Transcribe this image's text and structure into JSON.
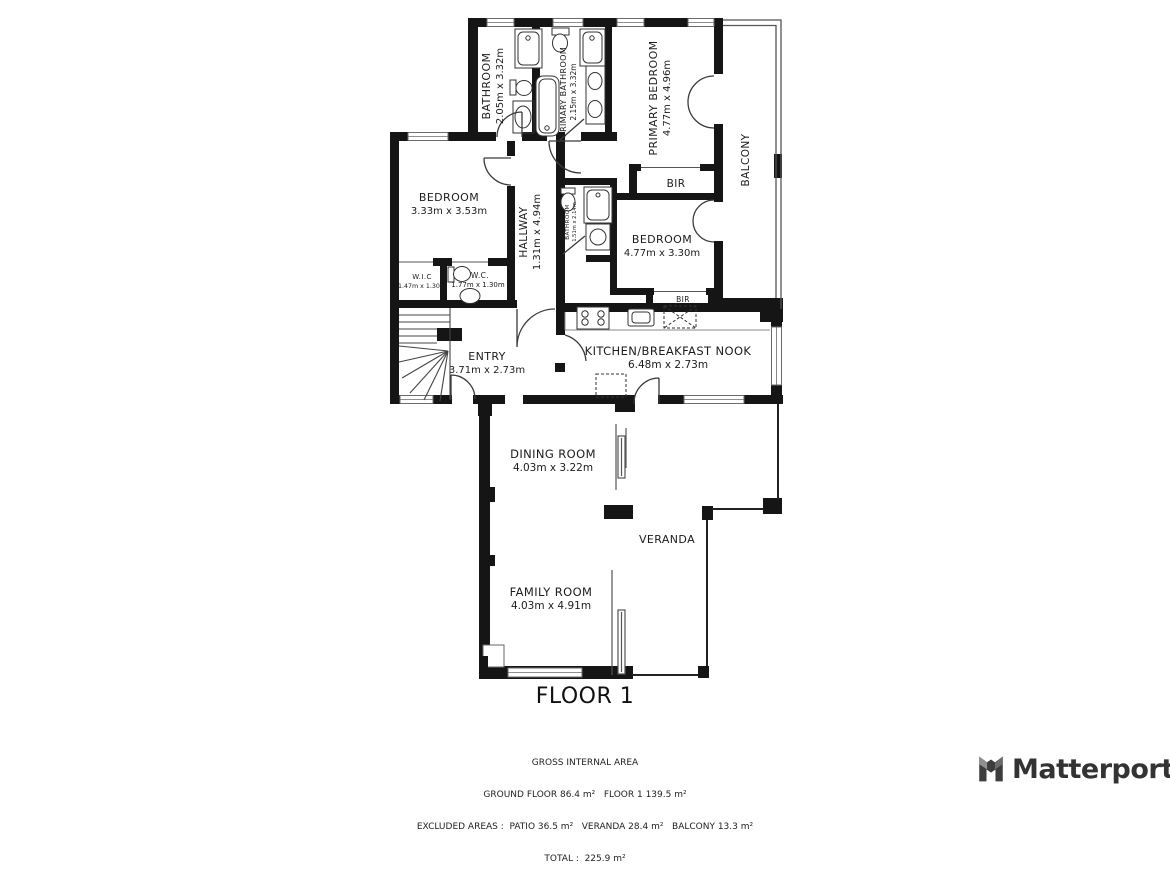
{
  "title": "FLOOR 1",
  "colors": {
    "wall": "#151515",
    "door_line": "#3a3a3a",
    "thin_line": "#666666",
    "brand_gray": "#3b3b3b"
  },
  "rooms": {
    "bathroom": {
      "name": "BATHROOM",
      "dims": "2.05m x 3.32m"
    },
    "primary_bathroom": {
      "name": "PRIMARY BATHROOM",
      "dims": "2.15m x 3.32m"
    },
    "primary_bedroom": {
      "name": "PRIMARY BEDROOM",
      "dims": "4.77m x 4.96m"
    },
    "balcony": {
      "name": "BALCONY"
    },
    "bedroom1": {
      "name": "BEDROOM",
      "dims": "3.33m x 3.53m"
    },
    "hallway": {
      "name": "HALLWAY",
      "dims": "1.31m x 4.94m"
    },
    "bathroom2": {
      "name": "BATHROOM",
      "dims": "1.51m x 2.14m"
    },
    "bir_top": {
      "name": "BIR"
    },
    "bedroom2": {
      "name": "BEDROOM",
      "dims": "4.77m x 3.30m"
    },
    "bir_bottom": {
      "name": "BIR"
    },
    "wic": {
      "name": "W.I.C",
      "dims": "1.47m x 1.30m"
    },
    "wc": {
      "name": "W.C.",
      "dims": "1.77m x 1.30m"
    },
    "entry": {
      "name": "ENTRY",
      "dims": "3.71m x 2.73m"
    },
    "kitchen": {
      "name": "KITCHEN/BREAKFAST NOOK",
      "dims": "6.48m x 2.73m"
    },
    "dining": {
      "name": "DINING ROOM",
      "dims": "4.03m x 3.22m"
    },
    "veranda": {
      "name": "VERANDA"
    },
    "family": {
      "name": "FAMILY ROOM",
      "dims": "4.03m x 4.91m"
    }
  },
  "footer": {
    "line1": "GROSS INTERNAL AREA",
    "line2": "GROUND FLOOR 86.4 m²   FLOOR 1 139.5 m²",
    "line3": "EXCLUDED AREAS :  PATIO 36.5 m²   VERANDA 28.4 m²   BALCONY 13.3 m²",
    "line4": "TOTAL :  225.9 m²"
  },
  "brand": {
    "name": "Matterport"
  }
}
